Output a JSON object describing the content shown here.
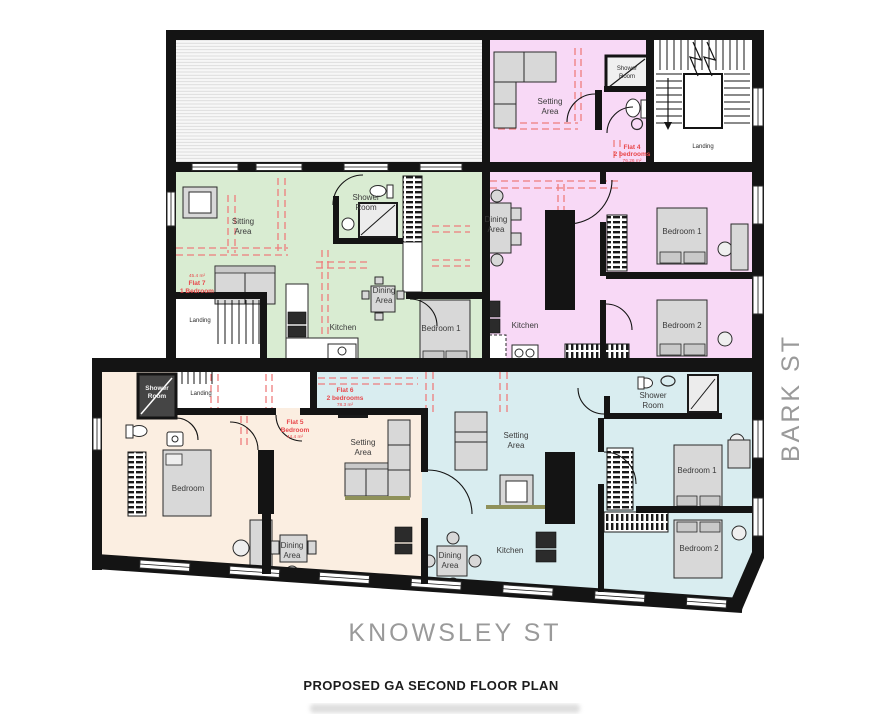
{
  "title": "PROPOSED GA SECOND FLOOR PLAN",
  "streets": {
    "bottom": "KNOWSLEY ST",
    "right": "BARK ST"
  },
  "words": {
    "sitting": "Sitting",
    "setting": "Setting",
    "area": "Area",
    "shower": "Shower",
    "room": "Room",
    "dining": "Dining",
    "kitchen": "Kitchen",
    "bedroom": "Bedroom",
    "bedroom1": "Bedroom 1",
    "bedroom2": "Bedroom 2",
    "landing": "Landing"
  },
  "flats": {
    "flat4": {
      "name": "Flat 4",
      "info": "2 bedrooms",
      "size": "76.26 m²",
      "color": "#f8d9f6"
    },
    "flat5": {
      "name": "Flat 5",
      "info": "Bedroom",
      "size": "44.4 m²",
      "color": "#fbeee1"
    },
    "flat6": {
      "name": "Flat 6",
      "info": "2 bedrooms",
      "size": "78.3 m²",
      "color": "#d9edf0"
    },
    "flat7": {
      "name": "Flat 7",
      "info": "1 Bedroom",
      "size": "45.4 m²",
      "color": "#d9ecd2"
    }
  },
  "colors": {
    "wall": "#141414",
    "annotation": "#e8474b",
    "dashed": "#ef7d7d",
    "street_text": "#9a9a9a",
    "furniture": "#d8d8d8"
  }
}
